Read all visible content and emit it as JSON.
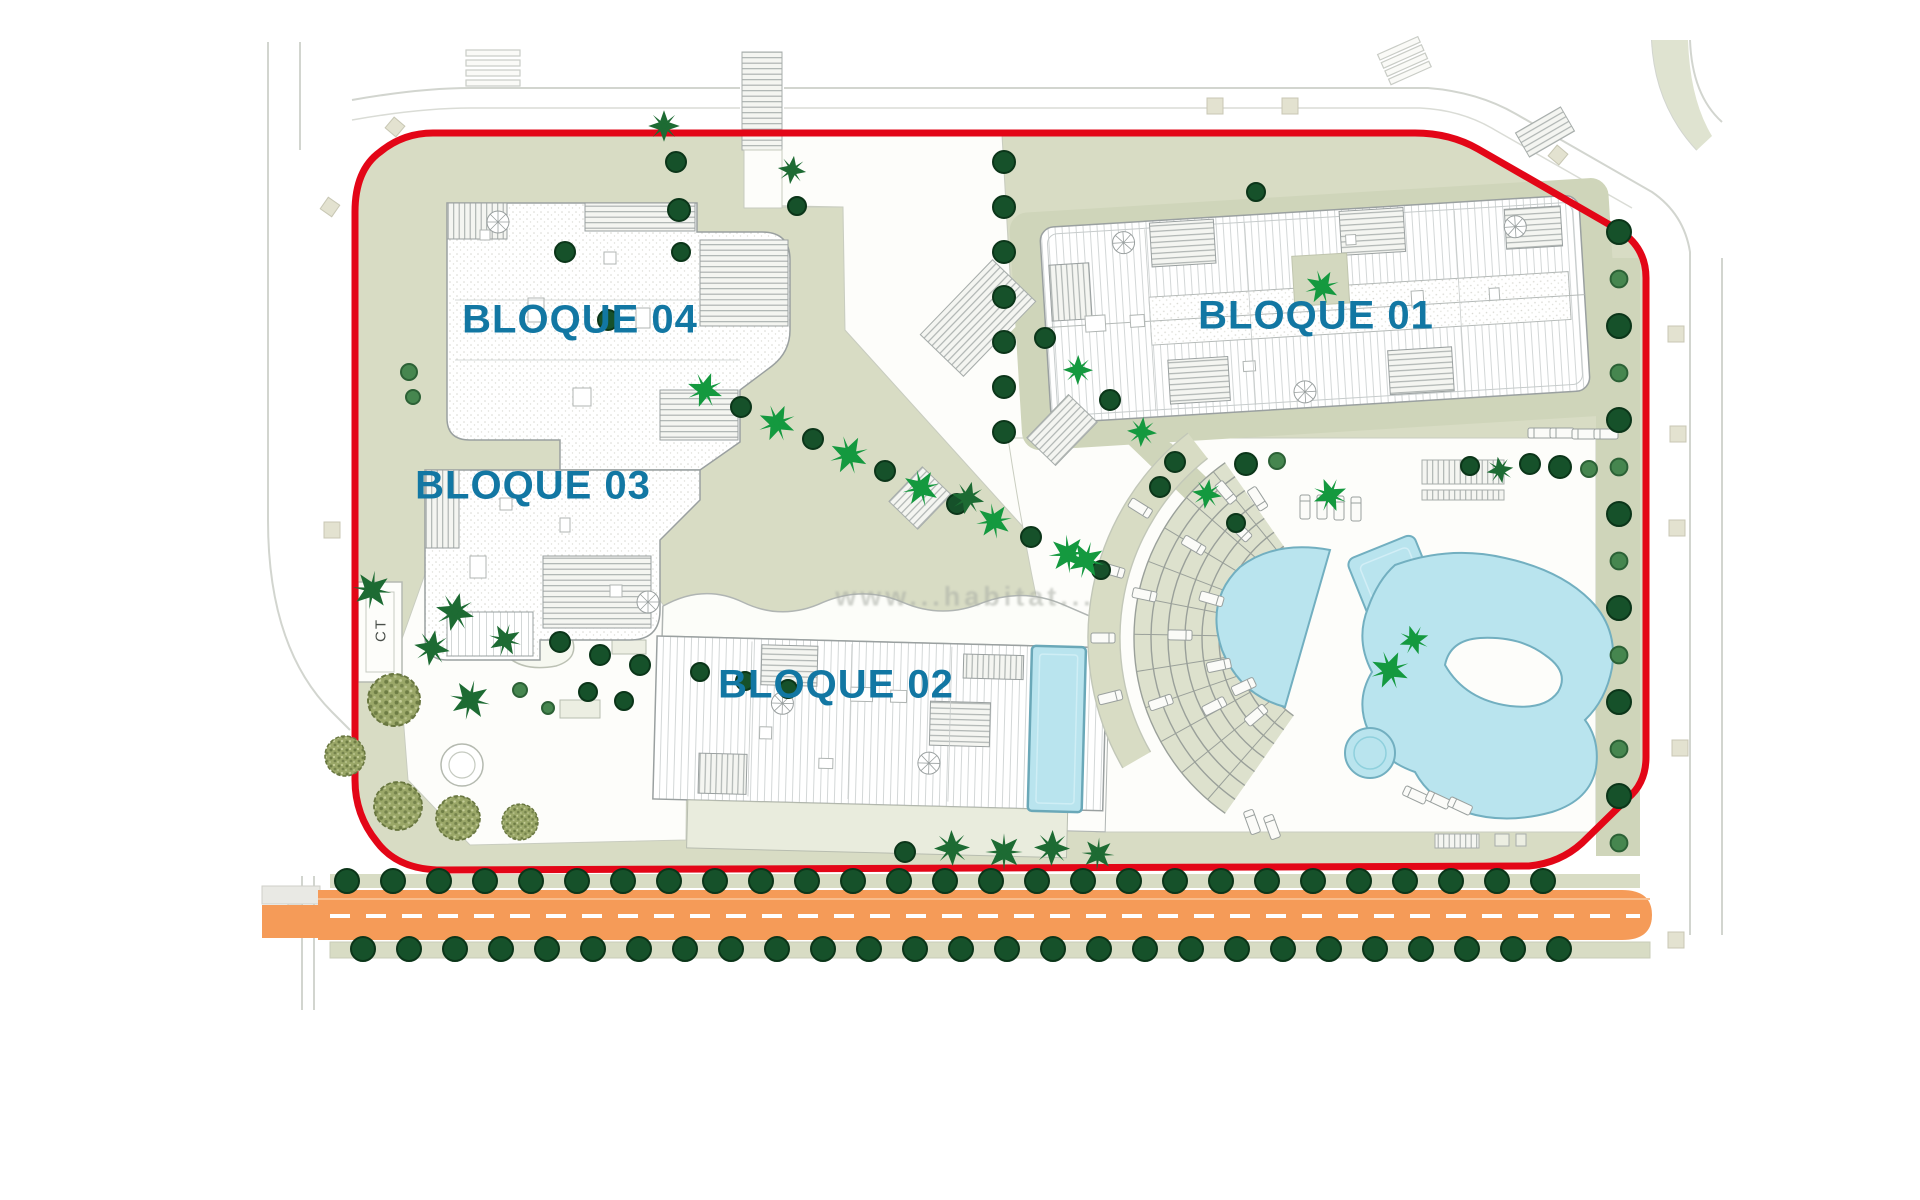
{
  "plan": {
    "block_labels": [
      {
        "id": "bloque-04",
        "text": "BLOQUE 04"
      },
      {
        "id": "bloque-03",
        "text": "BLOQUE 03"
      },
      {
        "id": "bloque-02",
        "text": "BLOQUE 02"
      },
      {
        "id": "bloque-01",
        "text": "BLOQUE 01"
      }
    ],
    "ct_label": "CT",
    "watermark": "www...habitat...",
    "colors": {
      "boundary_red": "#e30617",
      "road_orange": "#f59b58",
      "road_dash_white": "#ffffff",
      "label_teal": "#1277a3",
      "pool_cyan": "#b9e4ee",
      "pool_edge": "#72afc0",
      "sage_green": "#d8dcc4",
      "sage_dark": "#cfd5ba",
      "tree_dark_green": "#16512a",
      "tree_medium_green": "#46864f",
      "palm_bright_green": "#14993f",
      "palm_dark_green": "#1d6b33",
      "olive_green": "#9aa768",
      "building_outline": "#9aa0a0"
    }
  }
}
